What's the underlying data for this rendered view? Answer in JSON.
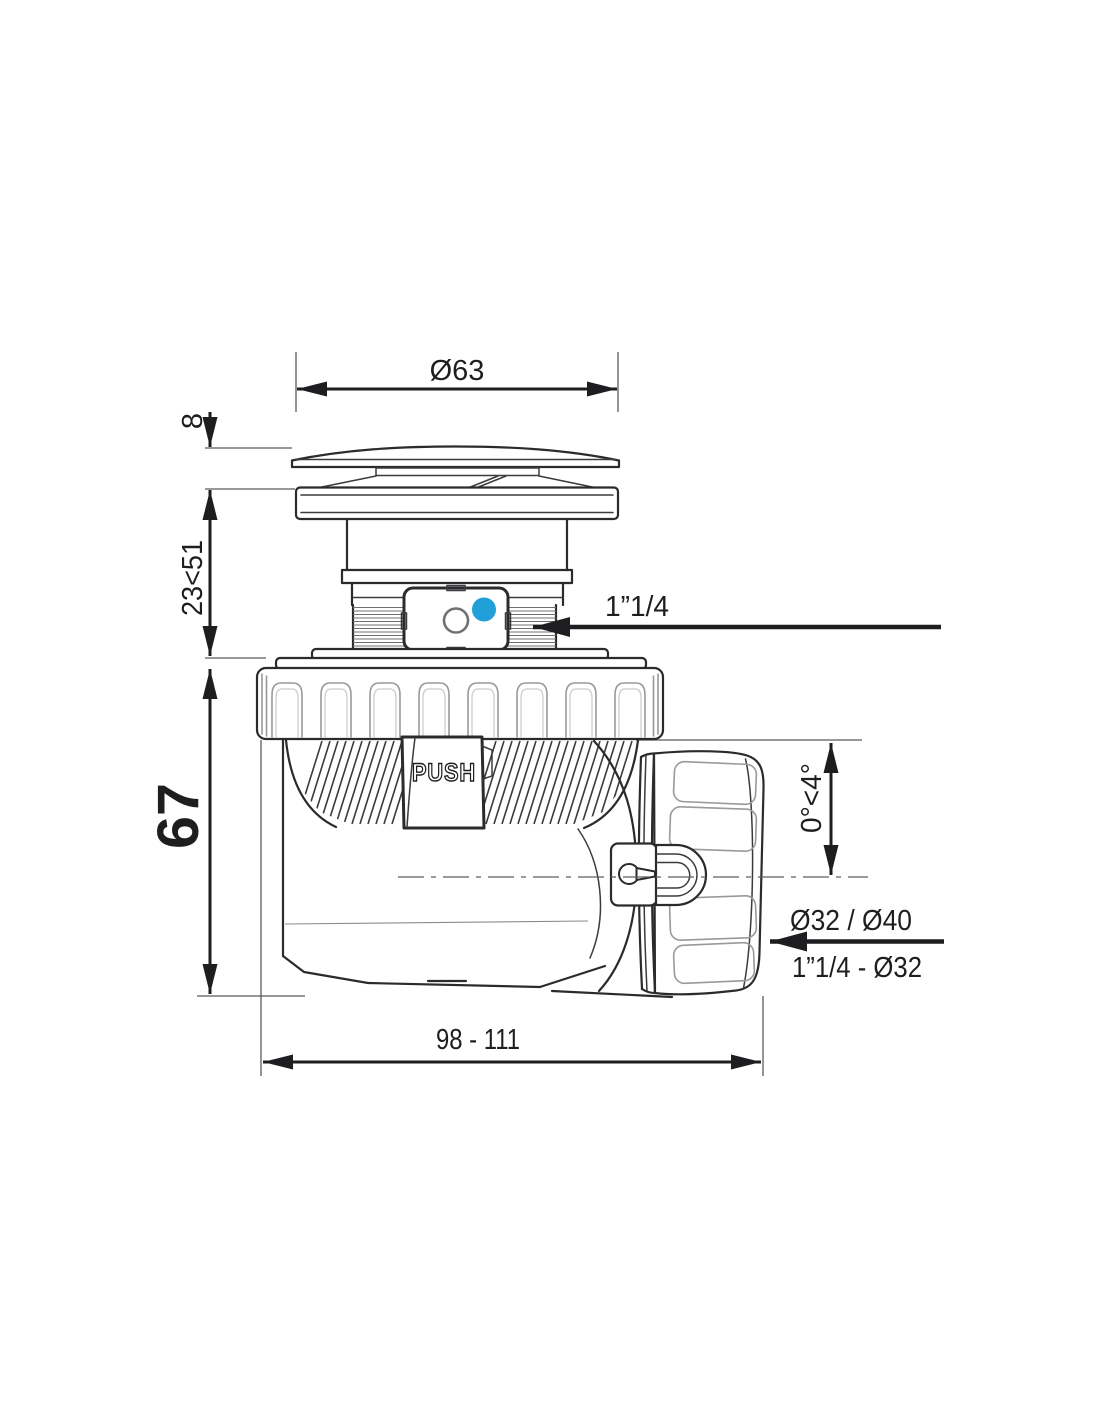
{
  "drawing": {
    "kind": "dimensioned technical drawing of a push-open bathtub/basin waste trap"
  },
  "dims": {
    "cap_diameter": "Ø63",
    "cap_height": "8",
    "height_adjust": "23<51",
    "body_height": "67",
    "inlet_thread": "1”1/4",
    "tilt_range": "0°<4°",
    "outlet_diameters": "Ø32 / Ø40",
    "outlet_thread": "1”1/4 - Ø32",
    "length_range": "98 - 111"
  },
  "labels": {
    "push": "PUSH"
  },
  "colors": {
    "line": "#1e1e20",
    "accent_blue": "#219fd8",
    "background": "#ffffff"
  }
}
